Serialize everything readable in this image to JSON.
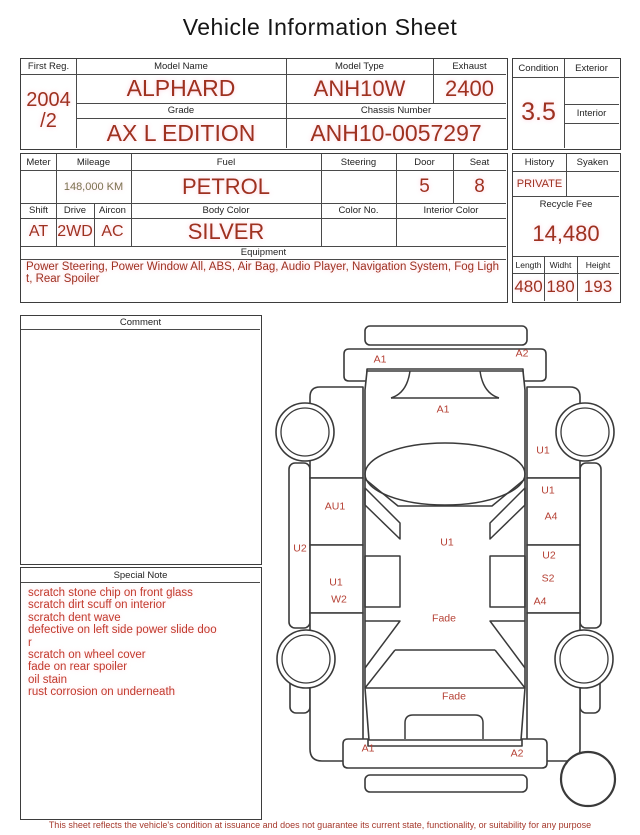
{
  "title": "Vehicle Information Sheet",
  "table1": {
    "first_reg_label": "First Reg.",
    "first_reg_line1": "2004",
    "first_reg_line2": "/2",
    "model_name_label": "Model Name",
    "model_name": "ALPHARD",
    "model_type_label": "Model Type",
    "model_type": "ANH10W",
    "exhaust_label": "Exhaust",
    "exhaust": "2400",
    "grade_label": "Grade",
    "grade": "AX L EDITION",
    "chassis_label": "Chassis Number",
    "chassis_number": "ANH10-0057297"
  },
  "condition_panel": {
    "condition_label": "Condition",
    "condition": "3.5",
    "exterior_label": "Exterior",
    "exterior": "",
    "interior_label": "Interior",
    "interior": ""
  },
  "table2": {
    "meter_label": "Meter",
    "meter": "",
    "mileage_label": "Mileage",
    "mileage": "148,000 KM",
    "fuel_label": "Fuel",
    "fuel": "PETROL",
    "steering_label": "Steering",
    "steering": "",
    "door_label": "Door",
    "door": "5",
    "seat_label": "Seat",
    "seat": "8",
    "shift_label": "Shift",
    "shift": "AT",
    "drive_label": "Drive",
    "drive": "2WD",
    "aircon_label": "Aircon",
    "aircon": "AC",
    "body_color_label": "Body Color",
    "body_color": "SILVER",
    "color_no_label": "Color No.",
    "color_no": "",
    "interior_color_label": "Interior Color",
    "interior_color": "",
    "equipment_label": "Equipment",
    "equipment": "Power Steering, Power Window  All, ABS, Air Bag, Audio Player, Navigation System, Fog Light, Rear Spoiler"
  },
  "history_panel": {
    "history_label": "History",
    "history": "PRIVATE",
    "syaken_label": "Syaken",
    "syaken": "",
    "recycle_fee_label": "Recycle Fee",
    "recycle_fee": "14,480",
    "length_label": "Length",
    "length": "480",
    "width_label": "Widht",
    "width": "180",
    "height_label": "Height",
    "height": "193"
  },
  "comment": {
    "label": "Comment",
    "text": ""
  },
  "special_note": {
    "label": "Special Note",
    "lines": [
      "scratch stone chip on front glass",
      "scratch dirt scuff on interior",
      "scratch dent wave",
      "defective on left side power slide doo",
      "r",
      "scratch on wheel cover",
      "fade on rear spoiler",
      "oil stain",
      "rust corrosion on underneath"
    ]
  },
  "diagram": {
    "labels": [
      {
        "text": "A1",
        "x": 110,
        "y": 44
      },
      {
        "text": "A2",
        "x": 252,
        "y": 38
      },
      {
        "text": "A1",
        "x": 173,
        "y": 94
      },
      {
        "text": "U1",
        "x": 273,
        "y": 135
      },
      {
        "text": "AU1",
        "x": 65,
        "y": 191
      },
      {
        "text": "U1",
        "x": 278,
        "y": 175
      },
      {
        "text": "A4",
        "x": 281,
        "y": 201
      },
      {
        "text": "U2",
        "x": 30,
        "y": 233
      },
      {
        "text": "U1",
        "x": 177,
        "y": 227
      },
      {
        "text": "U2",
        "x": 279,
        "y": 240
      },
      {
        "text": "U1",
        "x": 66,
        "y": 267
      },
      {
        "text": "S2",
        "x": 278,
        "y": 263
      },
      {
        "text": "W2",
        "x": 69,
        "y": 284
      },
      {
        "text": "A4",
        "x": 270,
        "y": 286
      },
      {
        "text": "Fade",
        "x": 174,
        "y": 303
      },
      {
        "text": "Fade",
        "x": 184,
        "y": 381
      },
      {
        "text": "A1",
        "x": 98,
        "y": 433
      },
      {
        "text": "A2",
        "x": 247,
        "y": 438
      }
    ]
  },
  "disclaimer": "This sheet reflects the vehicle's condition at issuance and does not guarantee its current state, functionality, or suitability for any purpose",
  "colors": {
    "value_red": "#9e3120",
    "note_red": "#c23a2c",
    "diagram_label_red": "#b54034",
    "mileage_olive": "#7b7250",
    "disclaimer_red": "#a5382b",
    "grid_line": "#4a4a4a"
  }
}
